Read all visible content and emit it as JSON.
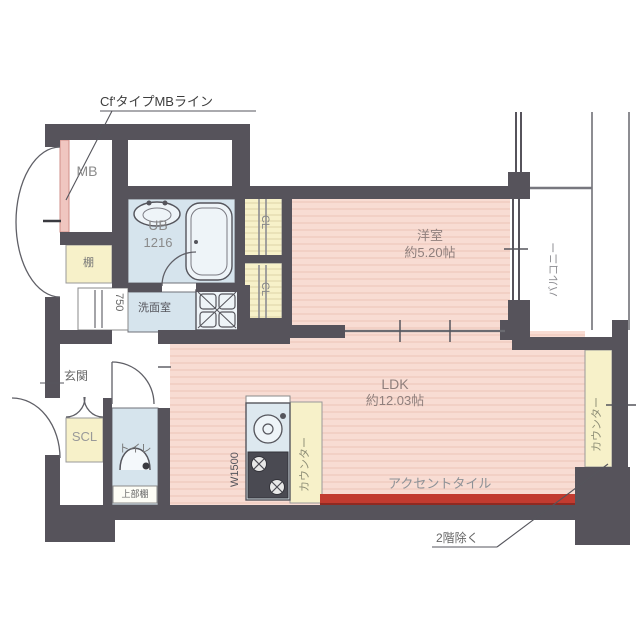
{
  "plan": {
    "note_top": "Cf'タイプMBライン",
    "note_bottom": "2階除く",
    "accent_tile_label": "アクセントタイル",
    "mb_label": "MB",
    "ub_label": "UB",
    "ub_size": "1216",
    "shelf_label": "棚",
    "closet_width": "750",
    "washroom_label": "洗面室",
    "cl_upper_label": "CL",
    "cl_lower_label": "CL",
    "bedroom_label": "洋室",
    "bedroom_size": "約5.20帖",
    "balcony_label": "バルコニー",
    "entrance_label": "玄関",
    "scl_label": "SCL",
    "toilet_label": "トイレ",
    "toilet_shelf_label": "上部棚",
    "kitchen_width_label": "W1500",
    "kitchen_counter_label": "カウンター",
    "ldk_label": "LDK",
    "ldk_size": "約12.03帖",
    "counter_label": "カウンター"
  },
  "colors": {
    "wall": "#56535b",
    "room_pink": "#f8dcd3",
    "stripe_pink": "#eec8bc",
    "wet_blue": "#d6e4ed",
    "storage_yellow": "#f7f1c9",
    "accent_red": "#c23b30",
    "mb_line_pink": "#f0c6c0"
  }
}
